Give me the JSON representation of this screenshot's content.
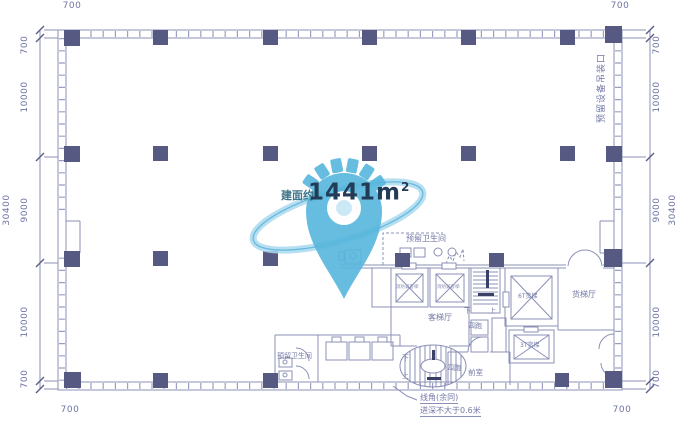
{
  "plan": {
    "area_watermark": {
      "prefix": "建面约",
      "value": "1441m",
      "exp": "2"
    },
    "annotations": {
      "equipment_opening": "预留设备吊装口",
      "corner_note_line1": "线角(余同)",
      "corner_note_line2": "进深不大于0.6米"
    },
    "rooms": {
      "reserved_toilet_top": "预留卫生间",
      "reserved_toilet_bottom": "预留卫生间",
      "passenger_lift_lobby": "客梯厅",
      "freight_lift_lobby": "货梯厅",
      "front_room": "前室",
      "lift_6t": "6T货梯",
      "lift_3t": "3T货梯",
      "fire_lift_a": "消防兼客梯",
      "fire_lift_b": "消防兼客梯",
      "stair1": {
        "down": "下",
        "up": "上",
        "runs": "四跑"
      },
      "stair2": {
        "down": "下",
        "up": "上",
        "runs": "四跑"
      }
    },
    "dimensions": {
      "top_left": "700",
      "top_right": "700",
      "bottom_left": "700",
      "bottom_right": "700",
      "left": {
        "total": "30400",
        "segments": [
          "700",
          "10000",
          "9000",
          "10000",
          "700"
        ]
      },
      "right": {
        "total": "30400",
        "segments": [
          "700",
          "10000",
          "9000",
          "10000",
          "700"
        ]
      }
    },
    "colors": {
      "line": "#8b90b6",
      "column": "#565a83",
      "dim_text": "#6e73a2",
      "watermark_blue": "#57b6dd",
      "orbit_blue": "#a9d9ee",
      "area_value_text": "#223c58",
      "area_prefix_text": "#3f7589"
    }
  }
}
